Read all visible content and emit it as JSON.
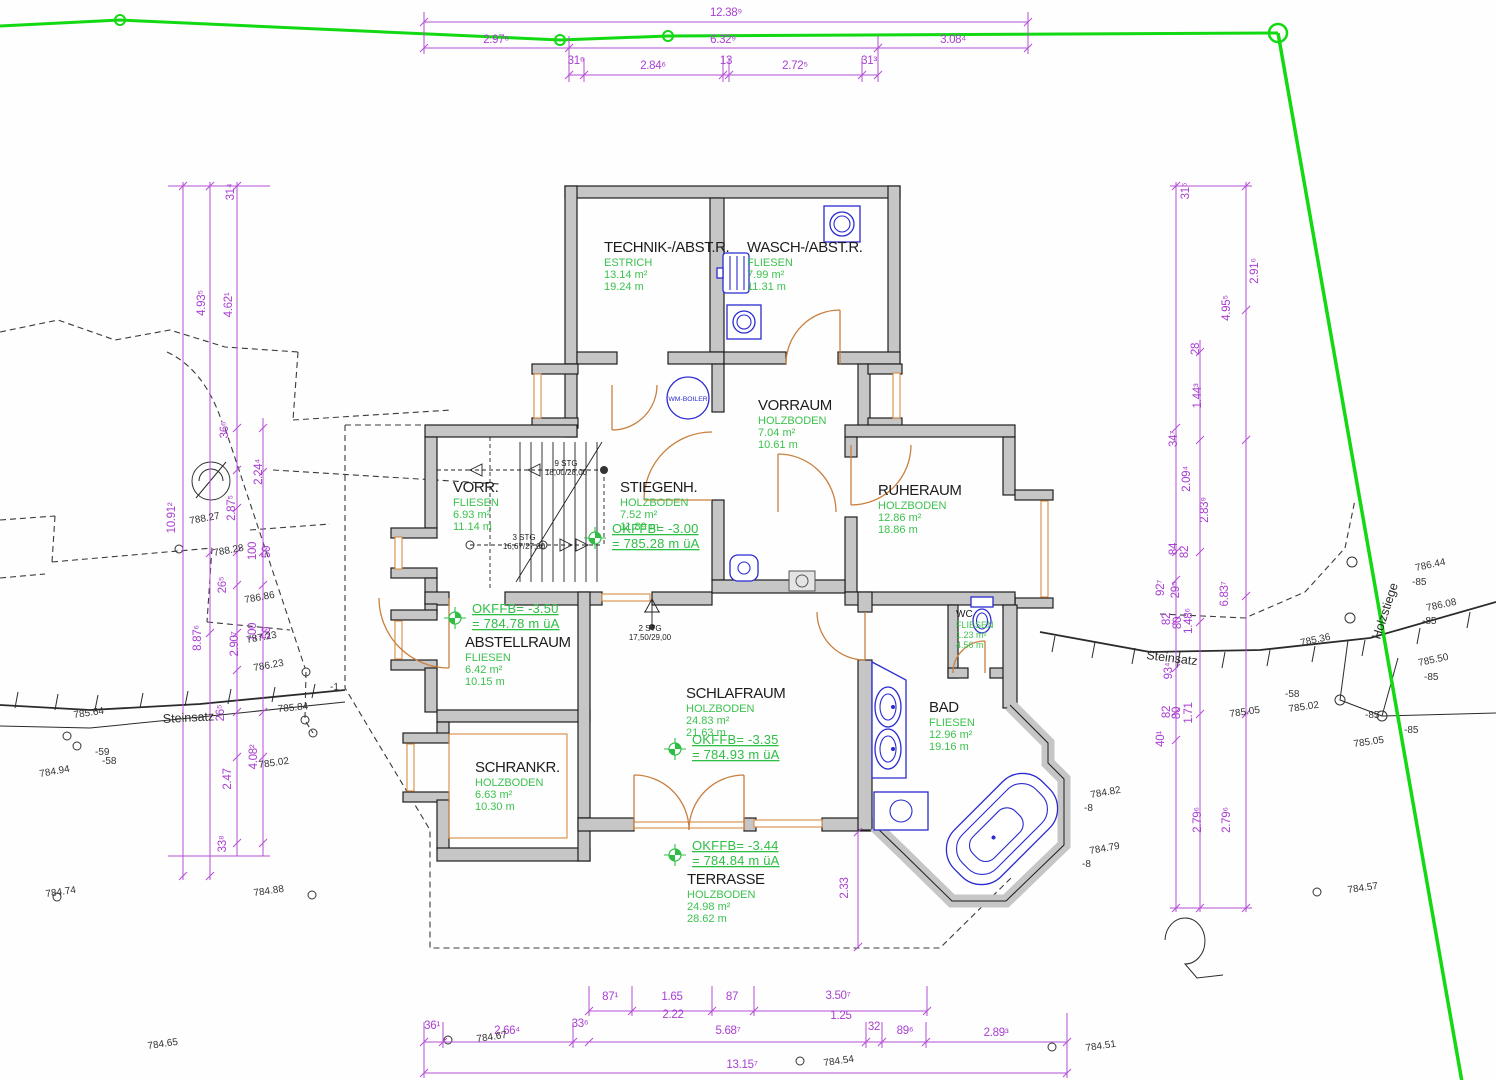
{
  "drawing_type": "architectural floor plan (basement level) with site survey",
  "colors": {
    "dimension": "#a93fd1",
    "area_text": "#3cc24e",
    "wall_fill": "#c6c6c6",
    "boundary_line": "#12d912",
    "fixtures": "#2b2bd0",
    "doors": "#c9803f"
  },
  "rooms": [
    {
      "name": "TECHNIK-/ABST.R.",
      "floor": "ESTRICH",
      "area": "13.14 m²",
      "perimeter": "19.24 m",
      "x": 604,
      "y": 252
    },
    {
      "name": "WASCH-/ABST.R.",
      "floor": "FLIESEN",
      "area": "7.99 m²",
      "perimeter": "11.31 m",
      "x": 747,
      "y": 252
    },
    {
      "name": "VORRAUM",
      "floor": "HOLZBODEN",
      "area": "7.04 m²",
      "perimeter": "10.61 m",
      "x": 758,
      "y": 410
    },
    {
      "name": "STIEGENH.",
      "floor": "HOLZBODEN",
      "area": "7.52 m²",
      "perimeter": "11.89 m",
      "x": 620,
      "y": 492
    },
    {
      "name": "RUHERAUM",
      "floor": "HOLZBODEN",
      "area": "12.86 m²",
      "perimeter": "18.86 m",
      "x": 878,
      "y": 495
    },
    {
      "name": "VORR.",
      "floor": "FLIESEN",
      "area": "6.93 m²",
      "perimeter": "11.14 m",
      "x": 453,
      "y": 492
    },
    {
      "name": "ABSTELLRAUM",
      "floor": "FLIESEN",
      "area": "6.42 m²",
      "perimeter": "10.15 m",
      "x": 465,
      "y": 647
    },
    {
      "name": "SCHRANKR.",
      "floor": "HOLZBODEN",
      "area": "6.63 m²",
      "perimeter": "10.30 m",
      "x": 475,
      "y": 772
    },
    {
      "name": "SCHLAFRAUM",
      "floor": "HOLZBODEN",
      "area": "24.83 m²",
      "perimeter": "21.63 m",
      "x": 686,
      "y": 698
    },
    {
      "name": "BAD",
      "floor": "FLIESEN",
      "area": "12.96 m²",
      "perimeter": "19.16 m",
      "x": 929,
      "y": 712
    },
    {
      "name": "WC",
      "floor": "FLIESEN",
      "area": "1.23 m²",
      "perimeter": "4.56 m",
      "x": 956,
      "y": 617,
      "small": true
    },
    {
      "name": "TERRASSE",
      "floor": "HOLZBODEN",
      "area": "24.98 m²",
      "perimeter": "28.62 m",
      "x": 687,
      "y": 884
    }
  ],
  "level_markers": [
    {
      "l1": "OKFFB=  -3.00",
      "l2": "=  785.28  m  üA",
      "x": 612,
      "y": 533
    },
    {
      "l1": "OKFFB=  -3.50",
      "l2": "=  784.78  m  üA",
      "x": 472,
      "y": 613
    },
    {
      "l1": "OKFFB=  -3.35",
      "l2": "=  784.93  m  üA",
      "x": 692,
      "y": 744
    },
    {
      "l1": "OKFFB=  -3.44",
      "l2": "=  784.84  m  üA",
      "x": 692,
      "y": 850
    }
  ],
  "stair_notes": [
    {
      "l1": "9 STG",
      "l2": "18,00/28,00",
      "x": 566,
      "y": 466
    },
    {
      "l1": "3 STG",
      "l2": "16,67/27,00",
      "x": 524,
      "y": 540
    },
    {
      "l1": "2 STG",
      "l2": "17,50/29,00",
      "x": 650,
      "y": 631
    }
  ],
  "equipment": [
    {
      "label": "WM-BOILER",
      "x": 688,
      "y": 401
    }
  ],
  "dims_top": [
    {
      "t": "12.38⁹",
      "x": 726,
      "y": 16
    },
    {
      "t": "2.97⁶",
      "x": 496,
      "y": 43
    },
    {
      "t": "6.32⁹",
      "x": 723,
      "y": 43
    },
    {
      "t": "3.08⁴",
      "x": 953,
      "y": 43
    },
    {
      "t": "31⁶",
      "x": 576,
      "y": 64
    },
    {
      "t": "2.84⁶",
      "x": 653,
      "y": 69
    },
    {
      "t": "13",
      "x": 726,
      "y": 64
    },
    {
      "t": "2.72⁵",
      "x": 795,
      "y": 69
    },
    {
      "t": "31³",
      "x": 869,
      "y": 64
    }
  ],
  "dims_bottom": [
    {
      "t": "87¹",
      "x": 610,
      "y": 1000
    },
    {
      "t": "1.65",
      "x": 672,
      "y": 1000
    },
    {
      "t": "2.22",
      "x": 673,
      "y": 1018
    },
    {
      "t": "87",
      "x": 732,
      "y": 1000
    },
    {
      "t": "3.50⁷",
      "x": 838,
      "y": 999
    },
    {
      "t": "1.25",
      "x": 841,
      "y": 1019
    },
    {
      "t": "36¹",
      "x": 432,
      "y": 1029
    },
    {
      "t": "2.66⁴",
      "x": 507,
      "y": 1034
    },
    {
      "t": "33⁶",
      "x": 580,
      "y": 1027
    },
    {
      "t": "5.68⁷",
      "x": 728,
      "y": 1034
    },
    {
      "t": "32",
      "x": 874,
      "y": 1030
    },
    {
      "t": "89⁶",
      "x": 905,
      "y": 1034
    },
    {
      "t": "2.89³",
      "x": 996,
      "y": 1036
    },
    {
      "t": "13.15⁷",
      "x": 742,
      "y": 1068
    }
  ],
  "dims_left": [
    {
      "t": "31⁴",
      "x": 234,
      "y": 192
    },
    {
      "t": "4.93⁵",
      "x": 205,
      "y": 303
    },
    {
      "t": "4.62¹",
      "x": 232,
      "y": 305
    },
    {
      "t": "36⁶",
      "x": 228,
      "y": 430
    },
    {
      "t": "2.24⁴",
      "x": 262,
      "y": 472
    },
    {
      "t": "2.87⁵",
      "x": 235,
      "y": 508
    },
    {
      "t": "100",
      "x": 256,
      "y": 551
    },
    {
      "t": "50",
      "x": 270,
      "y": 552
    },
    {
      "t": "10.91²",
      "x": 175,
      "y": 518
    },
    {
      "t": "26⁵",
      "x": 226,
      "y": 585
    },
    {
      "t": "8.87⁶",
      "x": 201,
      "y": 638
    },
    {
      "t": "2.90⁷",
      "x": 238,
      "y": 644
    },
    {
      "t": "100",
      "x": 256,
      "y": 632
    },
    {
      "t": "50",
      "x": 270,
      "y": 633
    },
    {
      "t": "26⁵",
      "x": 224,
      "y": 713
    },
    {
      "t": "2.47",
      "x": 231,
      "y": 779
    },
    {
      "t": "4.08²",
      "x": 257,
      "y": 757
    },
    {
      "t": "33⁸",
      "x": 226,
      "y": 844
    }
  ],
  "dims_right": [
    {
      "t": "31⁶",
      "x": 1189,
      "y": 191
    },
    {
      "t": "2.91⁶",
      "x": 1258,
      "y": 271
    },
    {
      "t": "4.95⁵",
      "x": 1230,
      "y": 308
    },
    {
      "t": "28",
      "x": 1199,
      "y": 349
    },
    {
      "t": "1.44³",
      "x": 1201,
      "y": 396
    },
    {
      "t": "34⁷",
      "x": 1177,
      "y": 439
    },
    {
      "t": "2.09⁴",
      "x": 1190,
      "y": 479
    },
    {
      "t": "2.83⁹",
      "x": 1208,
      "y": 510
    },
    {
      "t": "84",
      "x": 1177,
      "y": 549
    },
    {
      "t": "82",
      "x": 1188,
      "y": 552
    },
    {
      "t": "92⁷",
      "x": 1164,
      "y": 588
    },
    {
      "t": "29⁵",
      "x": 1179,
      "y": 590
    },
    {
      "t": "6.83⁷",
      "x": 1228,
      "y": 594
    },
    {
      "t": "82",
      "x": 1170,
      "y": 619
    },
    {
      "t": "80",
      "x": 1181,
      "y": 623
    },
    {
      "t": "1.48⁶",
      "x": 1192,
      "y": 621
    },
    {
      "t": "93⁴",
      "x": 1172,
      "y": 671
    },
    {
      "t": "82",
      "x": 1170,
      "y": 712
    },
    {
      "t": "80",
      "x": 1180,
      "y": 713
    },
    {
      "t": "1.71",
      "x": 1192,
      "y": 713
    },
    {
      "t": "40¹",
      "x": 1164,
      "y": 739
    },
    {
      "t": "2.79⁶",
      "x": 1201,
      "y": 820
    },
    {
      "t": "2.79⁶",
      "x": 1230,
      "y": 820
    }
  ],
  "dims_plan": [
    {
      "t": "2.33",
      "x": 848,
      "y": 888
    }
  ],
  "spot_heights": [
    {
      "t": "788.27",
      "x": 190,
      "y": 524,
      "r": -10
    },
    {
      "t": "788.28",
      "x": 214,
      "y": 556,
      "r": -10
    },
    {
      "t": "786.86",
      "x": 245,
      "y": 603,
      "r": -10
    },
    {
      "t": "787.23",
      "x": 247,
      "y": 643,
      "r": -10
    },
    {
      "t": "786.23",
      "x": 254,
      "y": 671,
      "r": -10
    },
    {
      "t": "785.84",
      "x": 278,
      "y": 712,
      "r": -5
    },
    {
      "t": "785.64",
      "x": 74,
      "y": 718,
      "r": -8
    },
    {
      "t": "784.94",
      "x": 40,
      "y": 777,
      "r": -10
    },
    {
      "t": "784.74",
      "x": 46,
      "y": 897,
      "r": -8
    },
    {
      "t": "784.88",
      "x": 254,
      "y": 896,
      "r": -8
    },
    {
      "t": "785.02",
      "x": 259,
      "y": 768,
      "r": -8
    },
    {
      "t": "-59",
      "x": 95,
      "y": 755,
      "r": 0
    },
    {
      "t": "-58",
      "x": 102,
      "y": 764,
      "r": 0
    },
    {
      "t": "-1",
      "x": 330,
      "y": 690,
      "r": 0
    },
    {
      "t": "784.65",
      "x": 148,
      "y": 1049,
      "r": -8
    },
    {
      "t": "784.67",
      "x": 477,
      "y": 1042,
      "r": -8
    },
    {
      "t": "784.54",
      "x": 824,
      "y": 1066,
      "r": -8
    },
    {
      "t": "784.51",
      "x": 1086,
      "y": 1051,
      "r": -8
    },
    {
      "t": "784.57",
      "x": 1348,
      "y": 893,
      "r": -8
    },
    {
      "t": "786.44",
      "x": 1416,
      "y": 571,
      "r": -12
    },
    {
      "t": "-85",
      "x": 1412,
      "y": 585,
      "r": 0
    },
    {
      "t": "786.08",
      "x": 1427,
      "y": 611,
      "r": -12
    },
    {
      "t": "-85",
      "x": 1422,
      "y": 624,
      "r": 0
    },
    {
      "t": "785.36",
      "x": 1301,
      "y": 646,
      "r": -12
    },
    {
      "t": "785.50",
      "x": 1419,
      "y": 666,
      "r": -12
    },
    {
      "t": "-85",
      "x": 1424,
      "y": 680,
      "r": 0
    },
    {
      "t": "785.02",
      "x": 1289,
      "y": 712,
      "r": -8
    },
    {
      "t": "-58",
      "x": 1285,
      "y": 697,
      "r": 0
    },
    {
      "t": "785.05",
      "x": 1230,
      "y": 717,
      "r": -8
    },
    {
      "t": "785.05",
      "x": 1354,
      "y": 747,
      "r": -8
    },
    {
      "t": "-85",
      "x": 1365,
      "y": 718,
      "r": 0
    },
    {
      "t": "-85",
      "x": 1404,
      "y": 733,
      "r": 0
    },
    {
      "t": "784.82",
      "x": 1091,
      "y": 798,
      "r": -10
    },
    {
      "t": "-8",
      "x": 1084,
      "y": 811,
      "r": 0
    },
    {
      "t": "784.79",
      "x": 1090,
      "y": 854,
      "r": -10
    },
    {
      "t": "-8",
      "x": 1082,
      "y": 867,
      "r": 0
    }
  ],
  "site_labels": [
    {
      "t": "Steinsatz",
      "x": 163,
      "y": 723,
      "r": -3
    },
    {
      "t": "Steinsatz",
      "x": 1146,
      "y": 659,
      "r": 7
    },
    {
      "t": "Holzstiege",
      "x": 1380,
      "y": 640,
      "r": -72
    }
  ]
}
